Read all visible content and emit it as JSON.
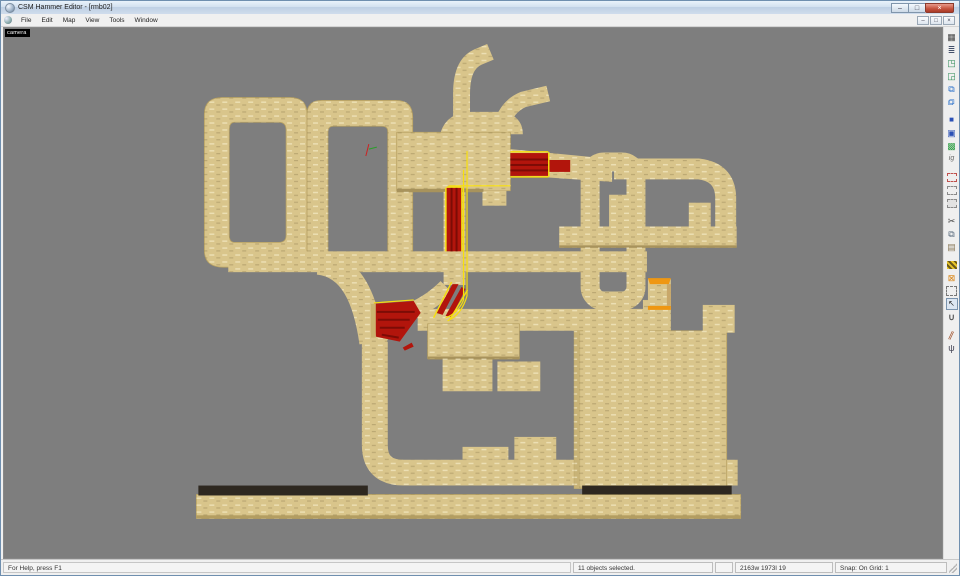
{
  "window": {
    "title": "CSM Hammer Editor - [rmb02]",
    "controls": {
      "minimize": "–",
      "restore": "□",
      "close": "×"
    }
  },
  "menubar": {
    "items": [
      "File",
      "Edit",
      "Map",
      "View",
      "Tools",
      "Window"
    ],
    "mdi_controls": {
      "minimize": "–",
      "restore": "□",
      "close": "×"
    }
  },
  "viewport": {
    "label": "camera"
  },
  "toolbar": {
    "icons": [
      {
        "name": "grid-toggle-icon",
        "glyph": "▦",
        "css": "color:#454545;font-size:9px"
      },
      {
        "name": "layer-stack-icon",
        "glyph": "≣",
        "css": "color:#44506a;font-size:9px"
      },
      {
        "name": "texture-lock-icon",
        "glyph": "◳",
        "css": "color:#2e8b57;font-size:9px"
      },
      {
        "name": "texture-shift-lock-icon",
        "glyph": "◲",
        "css": "color:#2e8b57;font-size:9px"
      },
      {
        "name": "group-icon",
        "glyph": "⧉",
        "css": "color:#2a6fc9;font-size:9px"
      },
      {
        "name": "ungroup-icon",
        "glyph": "⧉",
        "css": "color:#2a6fc9;font-size:9px;transform:scaleX(-1)"
      },
      {
        "sep": true
      },
      {
        "name": "cube-world-icon",
        "glyph": "■",
        "css": "color:#2b50b5;font-size:8px"
      },
      {
        "name": "cube-entity-icon",
        "glyph": "▣",
        "css": "color:#2b50b5;font-size:9px"
      },
      {
        "name": "cube-select-icon",
        "glyph": "▩",
        "css": "color:#2f9e44;font-size:9px"
      },
      {
        "name": "ignore-groups-icon",
        "glyph": "ig",
        "css": "color:#666;font-size:7px;font-style:italic"
      },
      {
        "sep": true
      },
      {
        "name": "hide-selected-icon",
        "glyph": "",
        "css": "width:8px;height:7px;border:1px dashed #c0504d"
      },
      {
        "name": "hide-unselected-icon",
        "glyph": "",
        "css": "width:8px;height:7px;border:1px dashed #8a8a8a"
      },
      {
        "name": "show-hidden-icon",
        "glyph": "",
        "css": "width:8px;height:7px;border:1px dashed #8a8a8a;background:#e2e2e2"
      },
      {
        "sep": true
      },
      {
        "name": "cut-icon",
        "glyph": "✂",
        "css": "color:#444;font-size:9px"
      },
      {
        "name": "copy-icon",
        "glyph": "⧉",
        "css": "color:#55677a;font-size:9px"
      },
      {
        "name": "paste-icon",
        "glyph": "▤",
        "css": "color:#8a7a5a;font-size:9px"
      },
      {
        "sep": true
      },
      {
        "name": "carve-icon",
        "glyph": "",
        "css": "width:10px;height:8px;background:repeating-linear-gradient(45deg,#e8c52a 0 2px,#6b5a1a 2px 4px)"
      },
      {
        "name": "hollow-icon",
        "glyph": "⊠",
        "css": "color:#d9820f;font-size:9px"
      },
      {
        "name": "selection-bounds-icon",
        "glyph": "",
        "css": "width:9px;height:8px;border:1px dashed #777"
      },
      {
        "name": "pointer-tool-icon",
        "glyph": "↖",
        "css": "color:#222;font-size:8px;border:1px solid #7a93ad;background:#dce6f2;width:10px;height:10px;line-height:10px;text-align:center"
      },
      {
        "name": "magnet-icon",
        "glyph": "∪",
        "css": "color:#555;font-size:9px;font-weight:bold"
      },
      {
        "sep": true
      },
      {
        "name": "clip-tool-icon",
        "glyph": "∥",
        "css": "color:#a0522d;font-size:9px;transform:rotate(25deg)"
      },
      {
        "name": "vertex-tool-icon",
        "glyph": "ψ",
        "css": "color:#445;font-size:9px"
      }
    ]
  },
  "statusbar": {
    "help": "For Help, press F1",
    "selection": "11 objects selected.",
    "coords": "2163w 1973l 19",
    "snap": "Snap: On Grid: 1"
  },
  "colors": {
    "track_tan": "#d9c58b",
    "viewport_gray": "#7e7e7e",
    "accent_red": "#b2150c",
    "selection_yellow": "#f7df0d",
    "orange_highlight": "#ef9712",
    "platform_dark": "#2e2820"
  }
}
